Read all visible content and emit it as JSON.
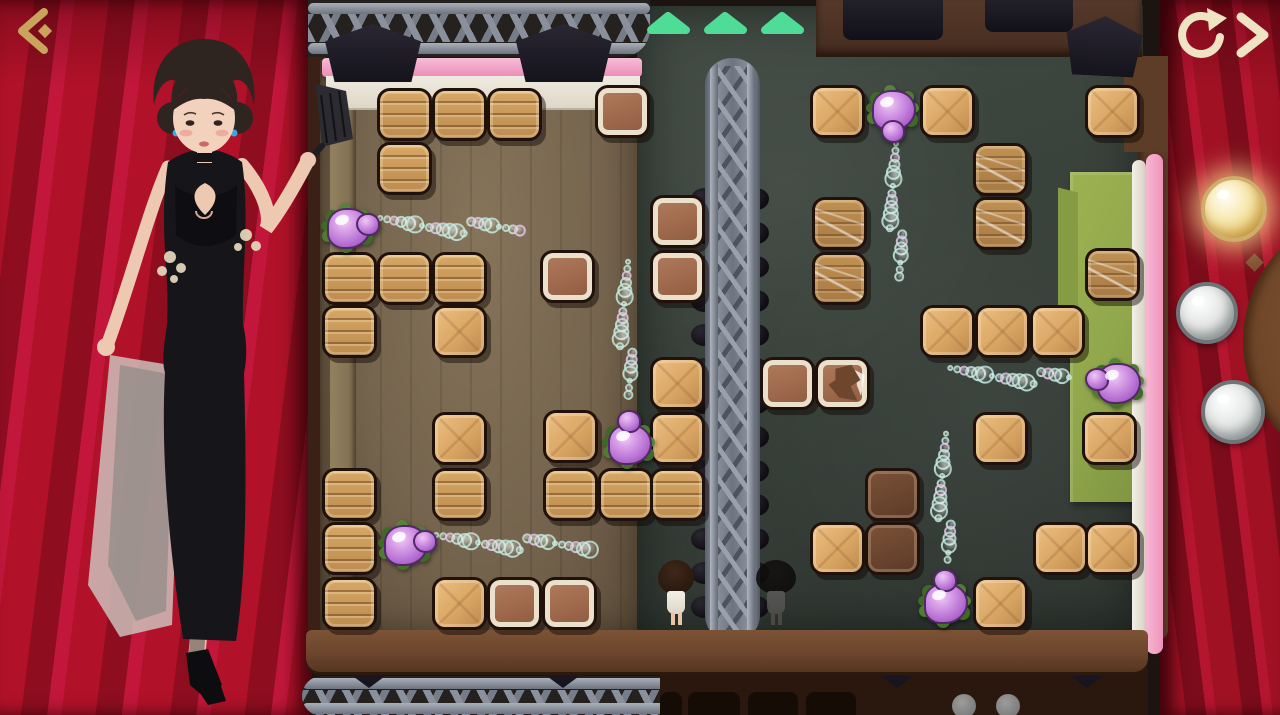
{
  "app": {
    "name": "slime-push-stage-puzzle"
  },
  "palette": {
    "curtain_red": "#a8132a",
    "triangle_green": "#4fdc97",
    "icon_gold": "#c9a45c",
    "icon_cream": "#efe3c4",
    "pink_light_bar": "#f4a9c9",
    "mat_green": "#90a74b",
    "slime_purple": "#bb76d6",
    "crate_wood": "#c9965a",
    "floor_dark": "#39413b",
    "floor_wood": "#76654e"
  },
  "hud": {
    "back_label": "back",
    "restart_label": "restart",
    "next_label": "next",
    "progress_triangles": {
      "count": 3,
      "color": "#4fdc97"
    },
    "score_orbs": [
      {
        "state": "lit"
      },
      {
        "state": "unlit"
      },
      {
        "state": "unlit"
      }
    ]
  },
  "board": {
    "crates": [
      {
        "x": 377,
        "y": 88,
        "t": "plank"
      },
      {
        "x": 432,
        "y": 88,
        "t": "plank"
      },
      {
        "x": 487,
        "y": 88,
        "t": "plank"
      },
      {
        "x": 377,
        "y": 142,
        "t": "plank"
      },
      {
        "x": 595,
        "y": 85,
        "t": "dark"
      },
      {
        "x": 322,
        "y": 252,
        "t": "plank"
      },
      {
        "x": 377,
        "y": 252,
        "t": "plank"
      },
      {
        "x": 432,
        "y": 252,
        "t": "plank"
      },
      {
        "x": 322,
        "y": 305,
        "t": "plank"
      },
      {
        "x": 432,
        "y": 305,
        "t": "smooth"
      },
      {
        "x": 540,
        "y": 250,
        "t": "dark"
      },
      {
        "x": 650,
        "y": 195,
        "t": "dark"
      },
      {
        "x": 650,
        "y": 250,
        "t": "dark"
      },
      {
        "x": 650,
        "y": 357,
        "t": "smooth"
      },
      {
        "x": 650,
        "y": 412,
        "t": "smooth"
      },
      {
        "x": 432,
        "y": 412,
        "t": "smooth"
      },
      {
        "x": 543,
        "y": 410,
        "t": "smooth"
      },
      {
        "x": 322,
        "y": 468,
        "t": "plank"
      },
      {
        "x": 432,
        "y": 468,
        "t": "plank"
      },
      {
        "x": 543,
        "y": 468,
        "t": "plank"
      },
      {
        "x": 598,
        "y": 468,
        "t": "plank"
      },
      {
        "x": 650,
        "y": 468,
        "t": "plank"
      },
      {
        "x": 322,
        "y": 522,
        "t": "plank"
      },
      {
        "x": 322,
        "y": 577,
        "t": "plank"
      },
      {
        "x": 432,
        "y": 577,
        "t": "smooth"
      },
      {
        "x": 487,
        "y": 577,
        "t": "dark"
      },
      {
        "x": 542,
        "y": 577,
        "t": "dark"
      },
      {
        "x": 810,
        "y": 85,
        "t": "smooth"
      },
      {
        "x": 920,
        "y": 85,
        "t": "smooth"
      },
      {
        "x": 1085,
        "y": 85,
        "t": "smooth"
      },
      {
        "x": 973,
        "y": 143,
        "t": "scratched"
      },
      {
        "x": 812,
        "y": 197,
        "t": "scratched"
      },
      {
        "x": 973,
        "y": 197,
        "t": "scratched"
      },
      {
        "x": 812,
        "y": 252,
        "t": "scratched"
      },
      {
        "x": 1085,
        "y": 248,
        "t": "scratched"
      },
      {
        "x": 920,
        "y": 305,
        "t": "smooth"
      },
      {
        "x": 975,
        "y": 305,
        "t": "smooth"
      },
      {
        "x": 1030,
        "y": 305,
        "t": "smooth"
      },
      {
        "x": 760,
        "y": 357,
        "t": "dark"
      },
      {
        "x": 815,
        "y": 357,
        "t": "broken"
      },
      {
        "x": 973,
        "y": 412,
        "t": "smooth"
      },
      {
        "x": 1082,
        "y": 412,
        "t": "smooth"
      },
      {
        "x": 865,
        "y": 468,
        "t": "darker"
      },
      {
        "x": 810,
        "y": 522,
        "t": "smooth"
      },
      {
        "x": 865,
        "y": 522,
        "t": "darker"
      },
      {
        "x": 1033,
        "y": 522,
        "t": "smooth"
      },
      {
        "x": 1085,
        "y": 522,
        "t": "smooth"
      },
      {
        "x": 973,
        "y": 577,
        "t": "smooth"
      }
    ],
    "slimes": [
      {
        "x": 316,
        "y": 196,
        "facing": "right"
      },
      {
        "x": 373,
        "y": 513,
        "facing": "right"
      },
      {
        "x": 597,
        "y": 412,
        "facing": "up"
      },
      {
        "x": 861,
        "y": 78,
        "facing": "down"
      },
      {
        "x": 1086,
        "y": 351,
        "facing": "left"
      },
      {
        "x": 913,
        "y": 571,
        "facing": "up"
      }
    ],
    "bubble_trails": [
      {
        "x1": 380,
        "y1": 224,
        "x2": 530,
        "y2": 230
      },
      {
        "x1": 436,
        "y1": 541,
        "x2": 600,
        "y2": 547
      },
      {
        "x1": 622,
        "y1": 262,
        "x2": 629,
        "y2": 408
      },
      {
        "x1": 890,
        "y1": 144,
        "x2": 900,
        "y2": 288
      },
      {
        "x1": 950,
        "y1": 374,
        "x2": 1082,
        "y2": 380
      },
      {
        "x1": 940,
        "y1": 434,
        "x2": 947,
        "y2": 568
      }
    ],
    "characters": [
      {
        "x": 658,
        "y": 560,
        "variant": "white"
      },
      {
        "x": 758,
        "y": 560,
        "variant": "shadow"
      }
    ],
    "truss_knobs": {
      "start": 188,
      "end": 628,
      "step": 34,
      "left_x": 691,
      "right_x": 743
    }
  }
}
